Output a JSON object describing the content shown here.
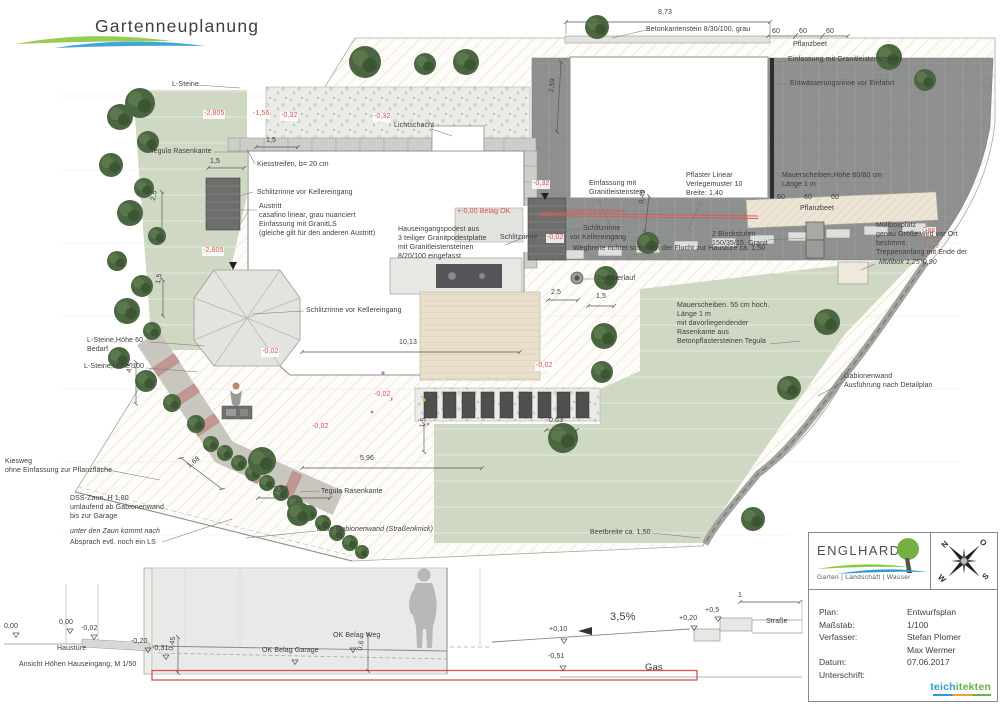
{
  "header": {
    "title": "Gartenneuplanung"
  },
  "colors": {
    "accent_red": "#d9534a",
    "logo_green": "#8dc63f",
    "logo_blue": "#2e9bd6",
    "lawn": "#ced8c3",
    "paving_dark": "#8e8f8f",
    "partner_blue": "#2e9bd6",
    "partner_green": "#6ab04c"
  },
  "plan": {
    "labels": [
      {
        "id": "dim-873",
        "t": "8,73",
        "x": 658,
        "y": 9
      },
      {
        "id": "note-betonkantenstein",
        "t": "Betonkantenstein 8/30/100, grau",
        "x": 646,
        "y": 26
      },
      {
        "id": "dim-60a",
        "t": "60",
        "x": 772,
        "y": 28
      },
      {
        "id": "dim-60b",
        "t": "60",
        "x": 799,
        "y": 28
      },
      {
        "id": "dim-60c",
        "t": "60",
        "x": 826,
        "y": 28
      },
      {
        "id": "note-pflanzbeet-top",
        "t": "Pflanzbeet",
        "x": 793,
        "y": 41
      },
      {
        "id": "note-einfassung-granit",
        "t": "Einfassung mit Granitleistensteinen",
        "x": 788,
        "y": 56
      },
      {
        "id": "note-entwaesserung",
        "t": "Entwässerungsrinne vor Einfahrt",
        "x": 790,
        "y": 80
      },
      {
        "id": "note-l-steine",
        "t": "L-Steine",
        "x": 172,
        "y": 81
      },
      {
        "id": "lvl-2805a",
        "t": "-2,805",
        "x": 203,
        "y": 110,
        "c": "red chip"
      },
      {
        "id": "lvl-156",
        "t": "-1,56",
        "x": 252,
        "y": 110,
        "c": "red chip"
      },
      {
        "id": "lvl-032a",
        "t": "-0,32",
        "x": 280,
        "y": 112,
        "c": "red chip"
      },
      {
        "id": "lvl-032b",
        "t": "-0,32",
        "x": 373,
        "y": 113,
        "c": "red chip"
      },
      {
        "id": "dim-259",
        "t": "2,59",
        "x": 548,
        "y": 92,
        "r": -83
      },
      {
        "id": "note-lichtschacht",
        "t": "Lichtschacht",
        "x": 394,
        "y": 122
      },
      {
        "id": "note-tegula-1",
        "t": "Tegula Rasenkante",
        "x": 150,
        "y": 148
      },
      {
        "id": "dim-15a",
        "t": "1,5",
        "x": 266,
        "y": 137
      },
      {
        "id": "dim-15b",
        "t": "1,5",
        "x": 210,
        "y": 158
      },
      {
        "id": "note-kiesstreifen",
        "t": "Kiesstreifen, b= 20 cm",
        "x": 257,
        "y": 161
      },
      {
        "id": "note-schlitzrinne-1",
        "t": "Schlitzrinne vor Kellereingang",
        "x": 257,
        "y": 189
      },
      {
        "id": "note-austritt",
        "t": "Austritt\ncasafino linear, grau nuanciert\nEinfassung mit GranitLS\n(gleiche gilt für den anderen Austritt)",
        "x": 259,
        "y": 203
      },
      {
        "id": "dim-25a",
        "t": "2,5",
        "x": 150,
        "y": 200,
        "r": -80
      },
      {
        "id": "lvl-2805b",
        "t": "-2,805",
        "x": 202,
        "y": 247,
        "c": "red chip"
      },
      {
        "id": "dim-15c",
        "t": "1,5",
        "x": 155,
        "y": 283,
        "r": -80
      },
      {
        "id": "lvl-000",
        "t": "+-0,00 Belag OK",
        "x": 457,
        "y": 208,
        "c": "red"
      },
      {
        "id": "note-podest",
        "t": "Hauseingangspodest aus\n3 teiliger Granitpodestplatte\nmit Granitleistensteinen\n8/20/100 eingefasst",
        "x": 398,
        "y": 226
      },
      {
        "id": "note-schlitzrinne-2",
        "t": "Schlitzrinne",
        "x": 583,
        "y": 225
      },
      {
        "id": "note-schlitzrinne-3",
        "t": "Schlitzrinne",
        "x": 500,
        "y": 234
      },
      {
        "id": "lvl-002a",
        "t": "-0,02",
        "x": 546,
        "y": 234,
        "c": "red chip"
      },
      {
        "id": "note-vor-keller",
        "t": "vor Kellereingang",
        "x": 570,
        "y": 234
      },
      {
        "id": "note-wegbreite",
        "t": "Wegbreite richtet sich nach der Flucht zur Haustüre ca. 1,50",
        "x": 573,
        "y": 245
      },
      {
        "id": "note-einfassung-2",
        "t": "Einfassung mit\nGranitleistenstein",
        "x": 589,
        "y": 180
      },
      {
        "id": "note-pflaster",
        "t": "Pflaster Linear\nVerlegemuster 10\nBreite: 1,40",
        "x": 686,
        "y": 172
      },
      {
        "id": "note-mauerscheiben-1",
        "t": "Mauerscheiben,Höhe 60/60 cm\nLänge 1 m",
        "x": 782,
        "y": 172
      },
      {
        "id": "dim-60d",
        "t": "60",
        "x": 777,
        "y": 194
      },
      {
        "id": "dim-60e",
        "t": "60",
        "x": 804,
        "y": 194
      },
      {
        "id": "dim-60f",
        "t": "60",
        "x": 831,
        "y": 194
      },
      {
        "id": "note-pflanzbeet-2",
        "t": "Pflanzbeet",
        "x": 800,
        "y": 205
      },
      {
        "id": "note-stromkabel",
        "t": "Stromkabel für Sprechanlage",
        "x": 566,
        "y": 208,
        "c": "red s5"
      },
      {
        "id": "dim-049",
        "t": "0,49",
        "x": 638,
        "y": 203,
        "r": -80
      },
      {
        "id": "note-blockstufen",
        "t": "2 Blockstufen\n150/35/15, Granit",
        "x": 712,
        "y": 231
      },
      {
        "id": "note-gas-plan",
        "t": "Gas",
        "x": 921,
        "y": 227,
        "c": "red chip"
      },
      {
        "id": "lvl-032c",
        "t": "-0,32",
        "x": 532,
        "y": 180,
        "c": "red chip"
      },
      {
        "id": "note-muellbox",
        "t": "Müllboxplatz\ngenau Größe wird vor Ort\nbestimmt.\nTreppenanfang mit Ende der",
        "x": 876,
        "y": 222
      },
      {
        "id": "note-muellbox-size",
        "t": "Müllbox 1,25*0,90",
        "x": 879,
        "y": 259,
        "c": "it"
      },
      {
        "id": "note-notueberlauf",
        "t": "Notüberlauf",
        "x": 598,
        "y": 275
      },
      {
        "id": "dim-25b",
        "t": "2,5",
        "x": 551,
        "y": 289
      },
      {
        "id": "dim-15d",
        "t": "1,5",
        "x": 596,
        "y": 293
      },
      {
        "id": "note-mauerscheiben-2",
        "t": "Mauerscheiben. 55 cm hoch.\nLänge 1 m\nmit davorliegendender\nRasenkante aus\nBetonpflastersteinen Tegula",
        "x": 677,
        "y": 302
      },
      {
        "id": "note-schlitzrinne-4",
        "t": "Schlitzrinne vor Kellereingang",
        "x": 306,
        "y": 307
      },
      {
        "id": "note-lsteine-60",
        "t": "L-Steine,Höhe 60\nBedarf",
        "x": 87,
        "y": 337
      },
      {
        "id": "note-lsteine-100",
        "t": "L-Steine,Höhe 100",
        "x": 84,
        "y": 363
      },
      {
        "id": "lvl-002b",
        "t": "-0,02",
        "x": 261,
        "y": 348,
        "c": "red chip"
      },
      {
        "id": "lvl-002c",
        "t": "-0,02",
        "x": 535,
        "y": 362,
        "c": "red chip"
      },
      {
        "id": "dim-1013",
        "t": "10,13",
        "x": 399,
        "y": 339
      },
      {
        "id": "lvl-002d",
        "t": "-0,02",
        "x": 373,
        "y": 391,
        "c": "red chip"
      },
      {
        "id": "lvl-002e",
        "t": "-0,02",
        "x": 311,
        "y": 423,
        "c": "red chip"
      },
      {
        "id": "dim-15e",
        "t": "1,5",
        "x": 419,
        "y": 427,
        "r": -80
      },
      {
        "id": "dim-063",
        "t": "0,63",
        "x": 549,
        "y": 417
      },
      {
        "id": "dim-596",
        "t": "5,96",
        "x": 360,
        "y": 455
      },
      {
        "id": "dim-168",
        "t": "1,68",
        "x": 186,
        "y": 464,
        "r": -38
      },
      {
        "id": "dim-283",
        "t": "2,83",
        "x": 274,
        "y": 486
      },
      {
        "id": "dim-45",
        "t": "4,5",
        "x": 126,
        "y": 372,
        "r": -80
      },
      {
        "id": "note-tegula-2",
        "t": "Tegula Rasenkante",
        "x": 321,
        "y": 488
      },
      {
        "id": "note-ende-gabione",
        "t": "Ende Gabionenwand (Straßenknick)",
        "x": 317,
        "y": 526,
        "c": "it"
      },
      {
        "id": "note-beetbreite",
        "t": "Beetbreite ca. 1,50",
        "x": 590,
        "y": 529
      },
      {
        "id": "note-gabionenwand",
        "t": "Gabionenwand\nAusführung nach Detailplan",
        "x": 844,
        "y": 373
      },
      {
        "id": "note-kiesweg",
        "t": "Kiesweg\nohne Einfassung zur Pflanzfläche",
        "x": 5,
        "y": 458
      },
      {
        "id": "note-zaun",
        "t": "DSS-Zaun, H 1,80\numlaufend ab Gabionenwand\nbis zur Garage",
        "x": 70,
        "y": 495
      },
      {
        "id": "note-zaun-it",
        "t": "unter den Zaun kommt nach",
        "x": 70,
        "y": 528,
        "c": "it"
      },
      {
        "id": "note-zaun-3",
        "t": "Absprach evtl. noch ein LS",
        "x": 70,
        "y": 539
      }
    ]
  },
  "section": {
    "labels": [
      {
        "id": "s-000a",
        "t": "0,00",
        "x": 4,
        "y": 623
      },
      {
        "id": "s-000b",
        "t": "0,00",
        "x": 59,
        "y": 619
      },
      {
        "id": "s-002",
        "t": "-0,02",
        "x": 81,
        "y": 625
      },
      {
        "id": "s-020",
        "t": "-0,20",
        "x": 131,
        "y": 638
      },
      {
        "id": "s-031",
        "t": "-0,31",
        "x": 152,
        "y": 645
      },
      {
        "id": "s-045",
        "t": "0,45",
        "x": 168,
        "y": 650,
        "r": -80
      },
      {
        "id": "s-haustuere",
        "t": "Haustüre",
        "x": 57,
        "y": 645
      },
      {
        "id": "s-caption",
        "t": "Ansicht Höhen Hauseingang, M 1/50",
        "x": 19,
        "y": 661
      },
      {
        "id": "s-ok-weg",
        "t": "OK Belag Weg",
        "x": 333,
        "y": 632
      },
      {
        "id": "s-ok-garage",
        "t": "OK Belag Garage",
        "x": 262,
        "y": 647
      },
      {
        "id": "s-06",
        "t": "0,6",
        "x": 357,
        "y": 650,
        "r": -80
      },
      {
        "id": "s-010",
        "t": "+0,10",
        "x": 549,
        "y": 626
      },
      {
        "id": "s-051",
        "t": "-0,51",
        "x": 548,
        "y": 653
      },
      {
        "id": "s-slope",
        "t": "3,5%",
        "x": 610,
        "y": 610,
        "c": "s11"
      },
      {
        "id": "s-020b",
        "t": "+0,20",
        "x": 679,
        "y": 615
      },
      {
        "id": "s-05",
        "t": "+0,5",
        "x": 705,
        "y": 607
      },
      {
        "id": "s-1",
        "t": "1",
        "x": 738,
        "y": 592
      },
      {
        "id": "s-strasse",
        "t": "Straße",
        "x": 766,
        "y": 618
      },
      {
        "id": "s-gas",
        "t": "Gas",
        "x": 645,
        "y": 662,
        "c": "s10"
      }
    ]
  },
  "title_block": {
    "company": "ENGLHARDT",
    "tagline": "Garten  |  Landschaft  |  Wasser",
    "compass": {
      "n": "N",
      "o": "O",
      "s": "S",
      "w": "W"
    },
    "rows": [
      {
        "label": "Plan:",
        "value": "Entwurfsplan"
      },
      {
        "label": "Maßstab:",
        "value": "1/100"
      },
      {
        "label": "Verfasser:",
        "value": "Stefan Plomer\nMax Wermer"
      },
      {
        "label": "Datum:",
        "value": "07.06.2017"
      },
      {
        "label": "Unterschrift:",
        "value": ""
      }
    ],
    "partner_logo": {
      "part1": "teich",
      "part2": "itekten"
    }
  }
}
